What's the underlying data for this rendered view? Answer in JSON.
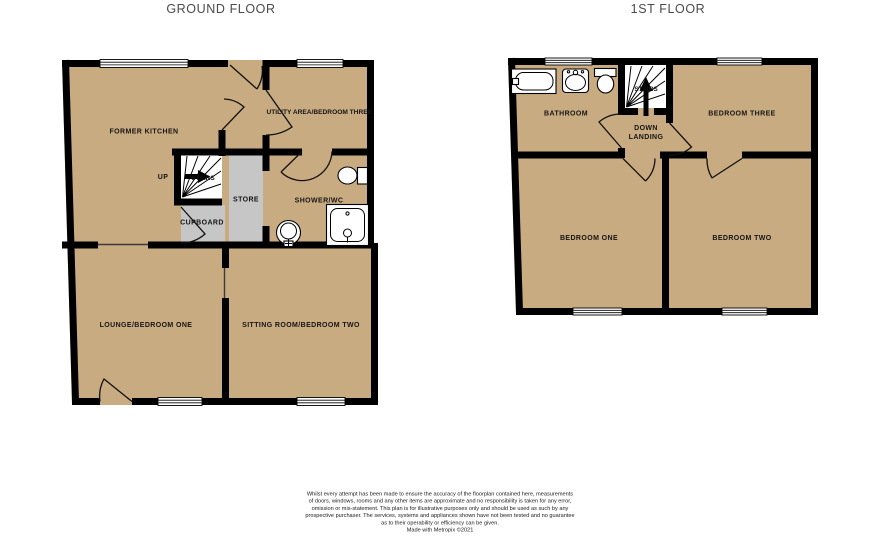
{
  "colors": {
    "floor_fill": "#c9ab81",
    "closet_fill": "#c6c6c6",
    "wall": "#000000",
    "title_text": "#4a4a4a",
    "label_text": "#141414",
    "background": "#ffffff"
  },
  "ground_floor": {
    "title": "GROUND FLOOR",
    "rooms": {
      "former_kitchen": "FORMER KITCHEN",
      "utility_area": "UTILITY AREA/BEDROOM THREE",
      "shower_wc": "SHOWER/WC",
      "store": "STORE",
      "cupboard": "CUPBOARD",
      "lounge": "LOUNGE/BEDROOM ONE",
      "sitting_room": "SITTING ROOM/BEDROOM TWO"
    },
    "stairs_label": "STAIRS",
    "up_label": "UP",
    "fixtures": [
      "toilet-icon",
      "pedestal-basin-icon",
      "shower-tray-icon"
    ]
  },
  "first_floor": {
    "title": "1ST FLOOR",
    "rooms": {
      "bathroom": "BATHROOM",
      "bedroom_three": "BEDROOM THREE",
      "bedroom_one": "BEDROOM ONE",
      "bedroom_two": "BEDROOM TWO"
    },
    "stairs_label": "STAIRS",
    "landing_label_line1": "DOWN",
    "landing_label_line2": "LANDING",
    "fixtures": [
      "bath-icon",
      "basin-icon",
      "toilet-icon"
    ]
  },
  "disclaimer": {
    "lines": [
      "Whilst every attempt has been made to ensure the accuracy of the floorplan contained here, measurements",
      "of doors, windows, rooms and any other items are approximate and no responsibility is taken for any error,",
      "omission or mis-statement. This plan is for illustrative purposes only and should be used as such by any",
      "prospective purchaser. The services, systems and appliances shown have not been tested and no guarantee",
      "as to their operability or efficiency can be given.",
      "Made with Metropix ©2021"
    ]
  }
}
